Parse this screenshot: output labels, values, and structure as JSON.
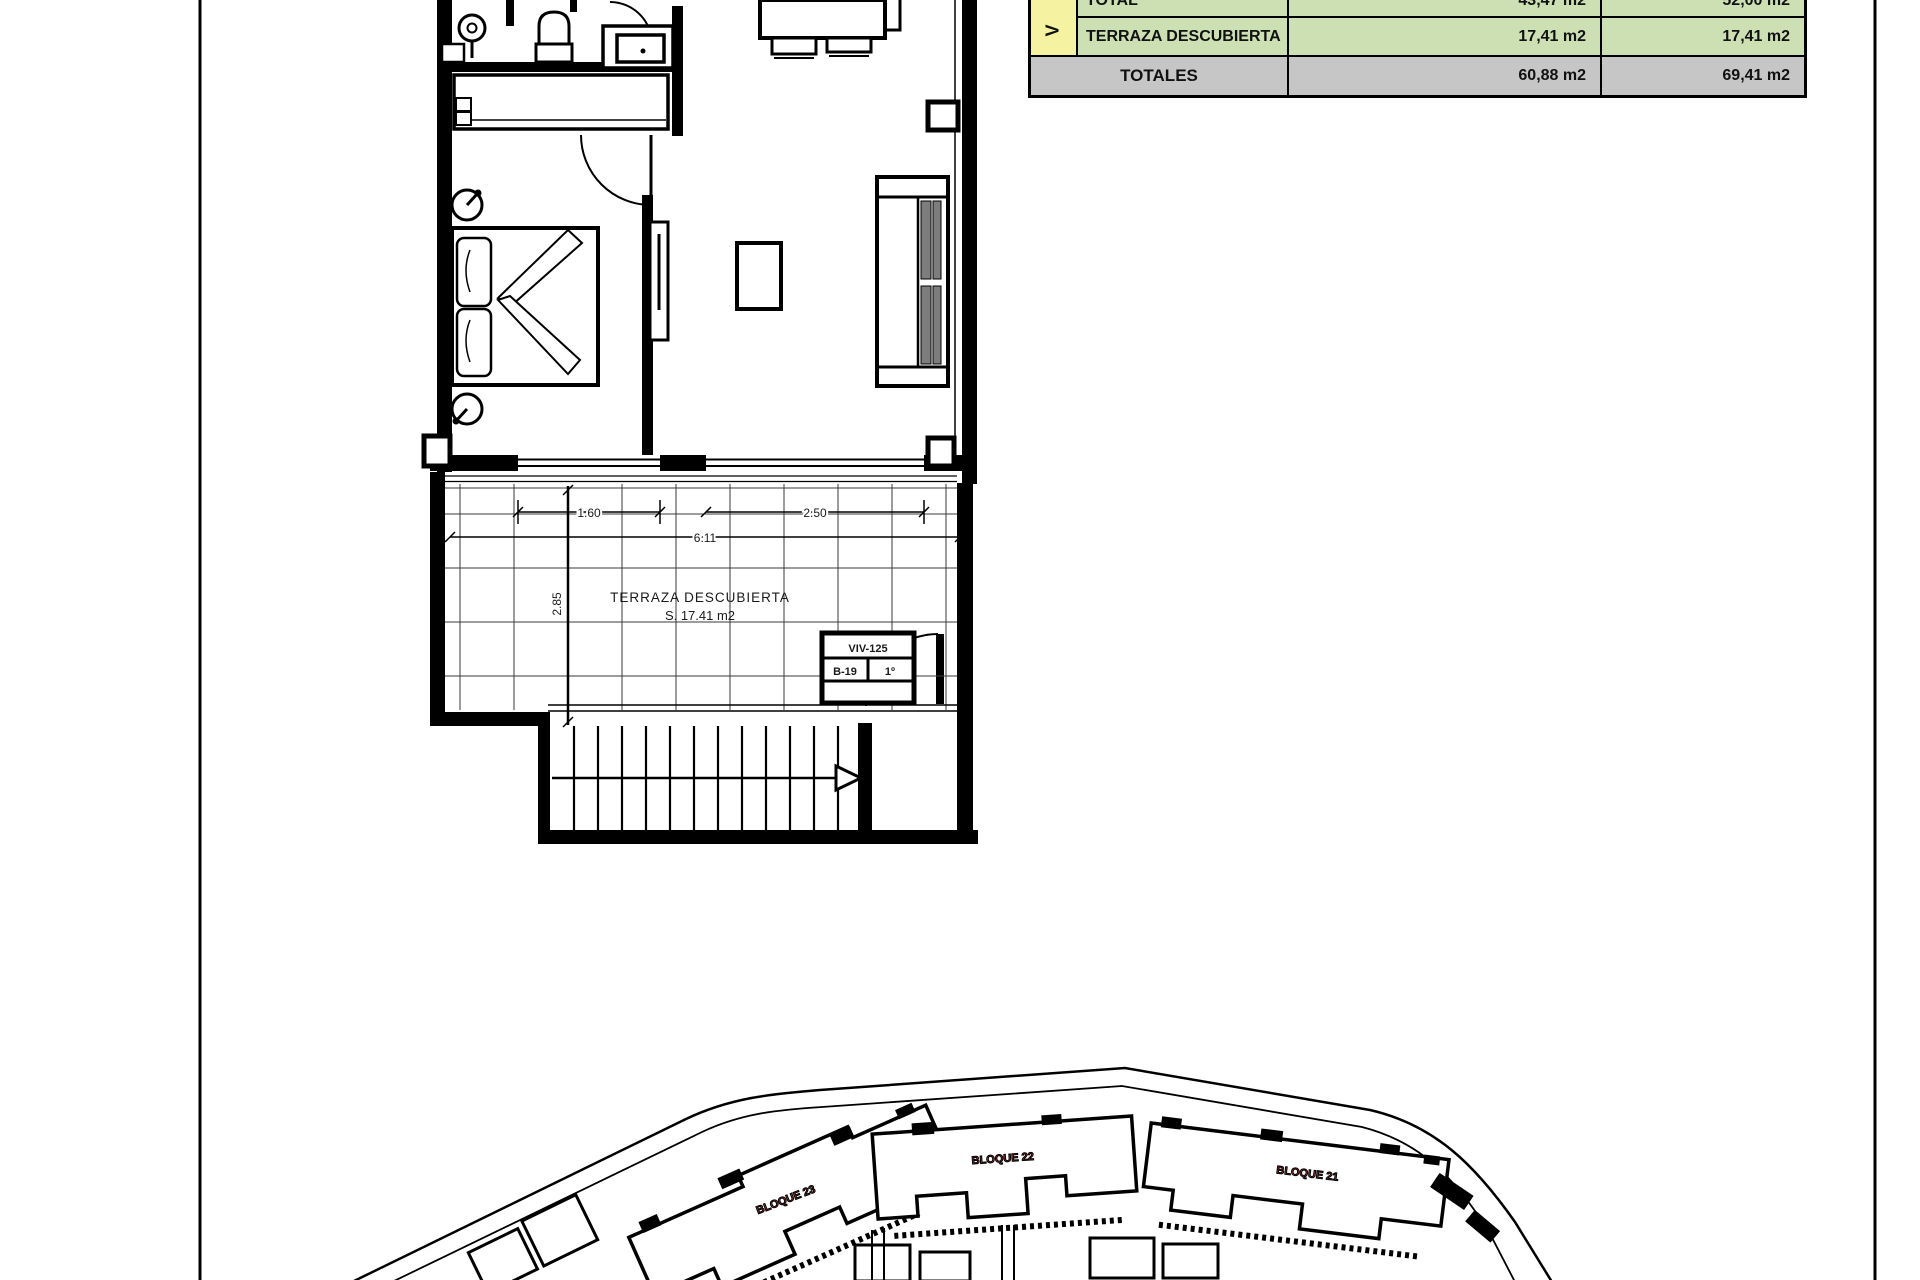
{
  "page": {
    "background": "#ffffff",
    "border_color": "#000000"
  },
  "area_table": {
    "vertical_label": "V",
    "rows": [
      {
        "label": "TOTAL",
        "util": "43,47 m2",
        "built": "52,00 m2"
      },
      {
        "label": "TERRAZA DESCUBIERTA",
        "util": "17,41 m2",
        "built": "17,41 m2"
      }
    ],
    "totals": {
      "label": "TOTALES",
      "util": "60,88 m2",
      "built": "69,41 m2"
    },
    "colors": {
      "highlight_yellow": "#f5f2a1",
      "cell_green": "#cde0b4",
      "totals_gray": "#c6c6c6"
    }
  },
  "floor_plan": {
    "terrace_title": "TERRAZA DESCUBIERTA",
    "terrace_area": "S. 17.41 m2",
    "dimensions": {
      "window_bedroom": "1.60",
      "window_living": "2.50",
      "total_width": "6.11",
      "terrace_depth": "2.85"
    },
    "unit_tag": {
      "line1": "VIV-125",
      "cell_a": "B-19",
      "cell_b": "1º"
    }
  },
  "site_plan": {
    "label_color": "#a33a38",
    "blocks": [
      {
        "label": "BLOQUE 23"
      },
      {
        "label": "BLOQUE 22"
      },
      {
        "label": "BLOQUE 21"
      }
    ]
  }
}
